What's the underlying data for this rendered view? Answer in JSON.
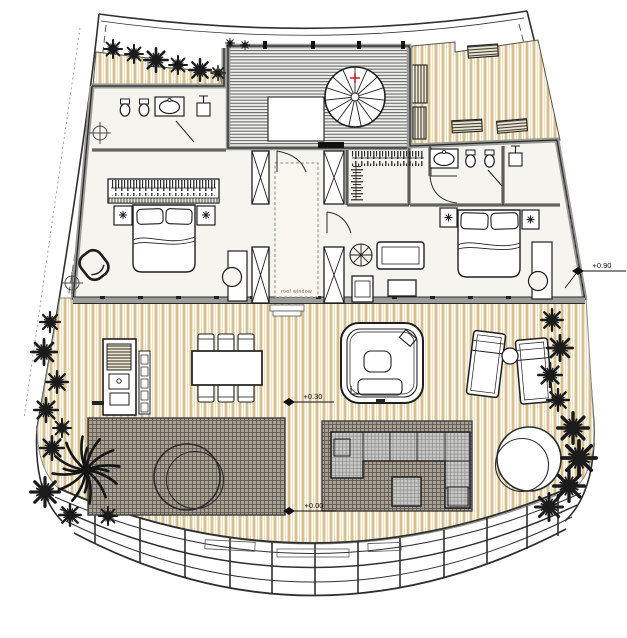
{
  "drawing": {
    "labels": {
      "roof_window": "roof window"
    },
    "elevation_markers": [
      {
        "id": "upper-floor-level",
        "text": "+0.90"
      },
      {
        "id": "main-deck-level",
        "text": "+0.30"
      },
      {
        "id": "lower-terrace-level",
        "text": "+0.00"
      }
    ]
  },
  "colors": {
    "background": "#ffffff",
    "line": "#2f2f2f",
    "wall_gray": "#9a9a96",
    "floor": "#f5f4ef",
    "wood_plank": "#d8c08c",
    "wood_background": "#fcf9f1",
    "stair_hatch": "#6b6b6b",
    "paving_base": "#a9a195",
    "paving_grid": "#5f594f",
    "upholstery_gray": "#c9c9c7",
    "plant_black": "#1b1b1b",
    "stair_marker_red": "#c22222"
  },
  "icons": [
    "spiral-staircase-icon",
    "roof-window",
    "structural-column",
    "double-bed-icon",
    "wardrobe-icon",
    "nightstand-lamp-icon",
    "armchair-icon",
    "sofa-icon",
    "coffee-table-icon",
    "side-table-icon",
    "potted-plant-icon",
    "toilet-icon",
    "bidet-icon",
    "washbasin-icon",
    "shower-icon",
    "outdoor-kitchen-icon",
    "dining-table-icon",
    "dining-chair-icon",
    "jacuzzi-icon",
    "sun-lounger-icon",
    "round-side-table-icon",
    "round-daybed-icon",
    "outdoor-sofa-icon",
    "palm-tree-icon",
    "shrub-icon",
    "bench-icon",
    "elevation-marker-icon",
    "survey-point-icon",
    "door-swing-icon"
  ]
}
